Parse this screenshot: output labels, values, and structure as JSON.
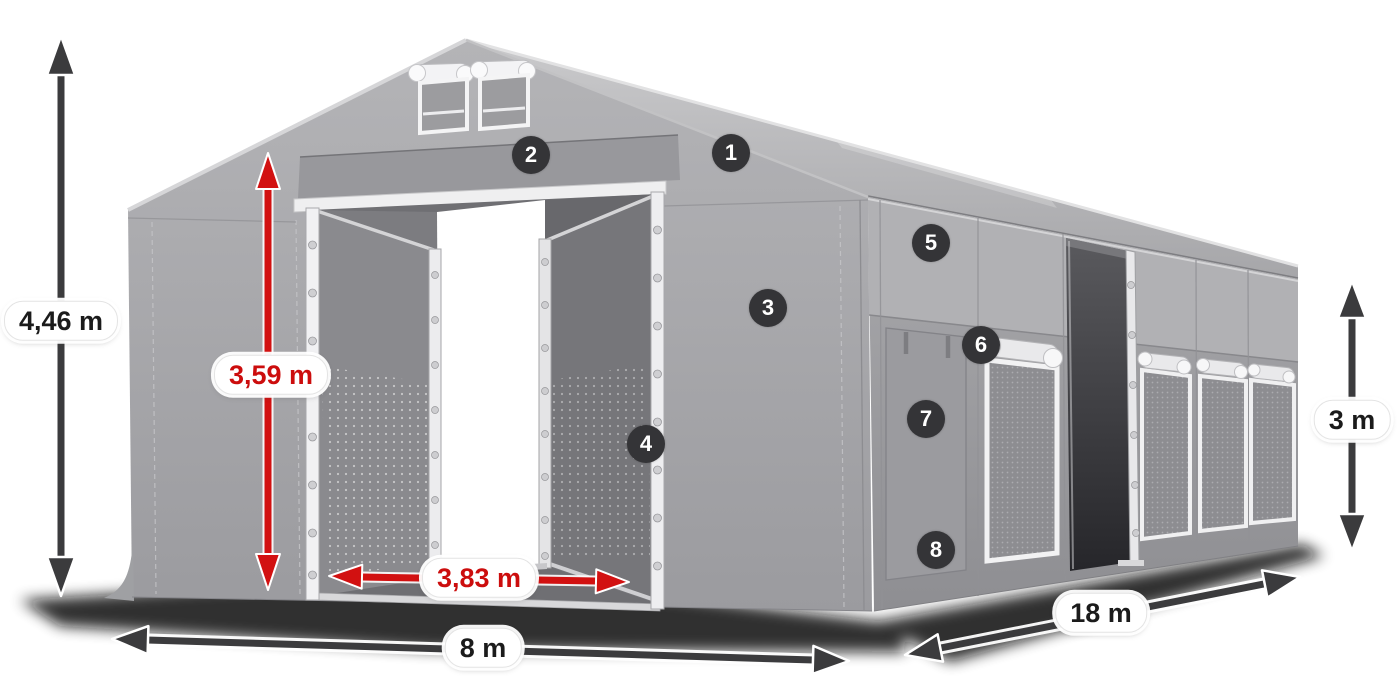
{
  "illustration": {
    "subject": "storage-tent",
    "view": "front-left-perspective",
    "fabric_color": "#a3a3a6",
    "frame_color": "#ededef"
  },
  "annotation_style": {
    "arrow_dark_color": "#3b3b3d",
    "arrow_red_color": "#d21111",
    "label_background": "#ffffff",
    "label_text_dark": "#1b1b1b",
    "label_text_red": "#cc0d0d",
    "badge_background": "#343437",
    "badge_text_color": "#ffffff"
  },
  "dimensions": {
    "total_height": {
      "label": "4,46 m",
      "style": "dark"
    },
    "door_height": {
      "label": "3,59 m",
      "style": "red"
    },
    "door_width": {
      "label": "3,83 m",
      "style": "red"
    },
    "front_width": {
      "label": "8 m",
      "style": "dark"
    },
    "side_length": {
      "label": "18 m",
      "style": "dark"
    },
    "side_height": {
      "label": "3 m",
      "style": "dark"
    }
  },
  "feature_markers": [
    {
      "label": "1"
    },
    {
      "label": "2"
    },
    {
      "label": "3"
    },
    {
      "label": "4"
    },
    {
      "label": "5"
    },
    {
      "label": "6"
    },
    {
      "label": "7"
    },
    {
      "label": "8"
    }
  ]
}
